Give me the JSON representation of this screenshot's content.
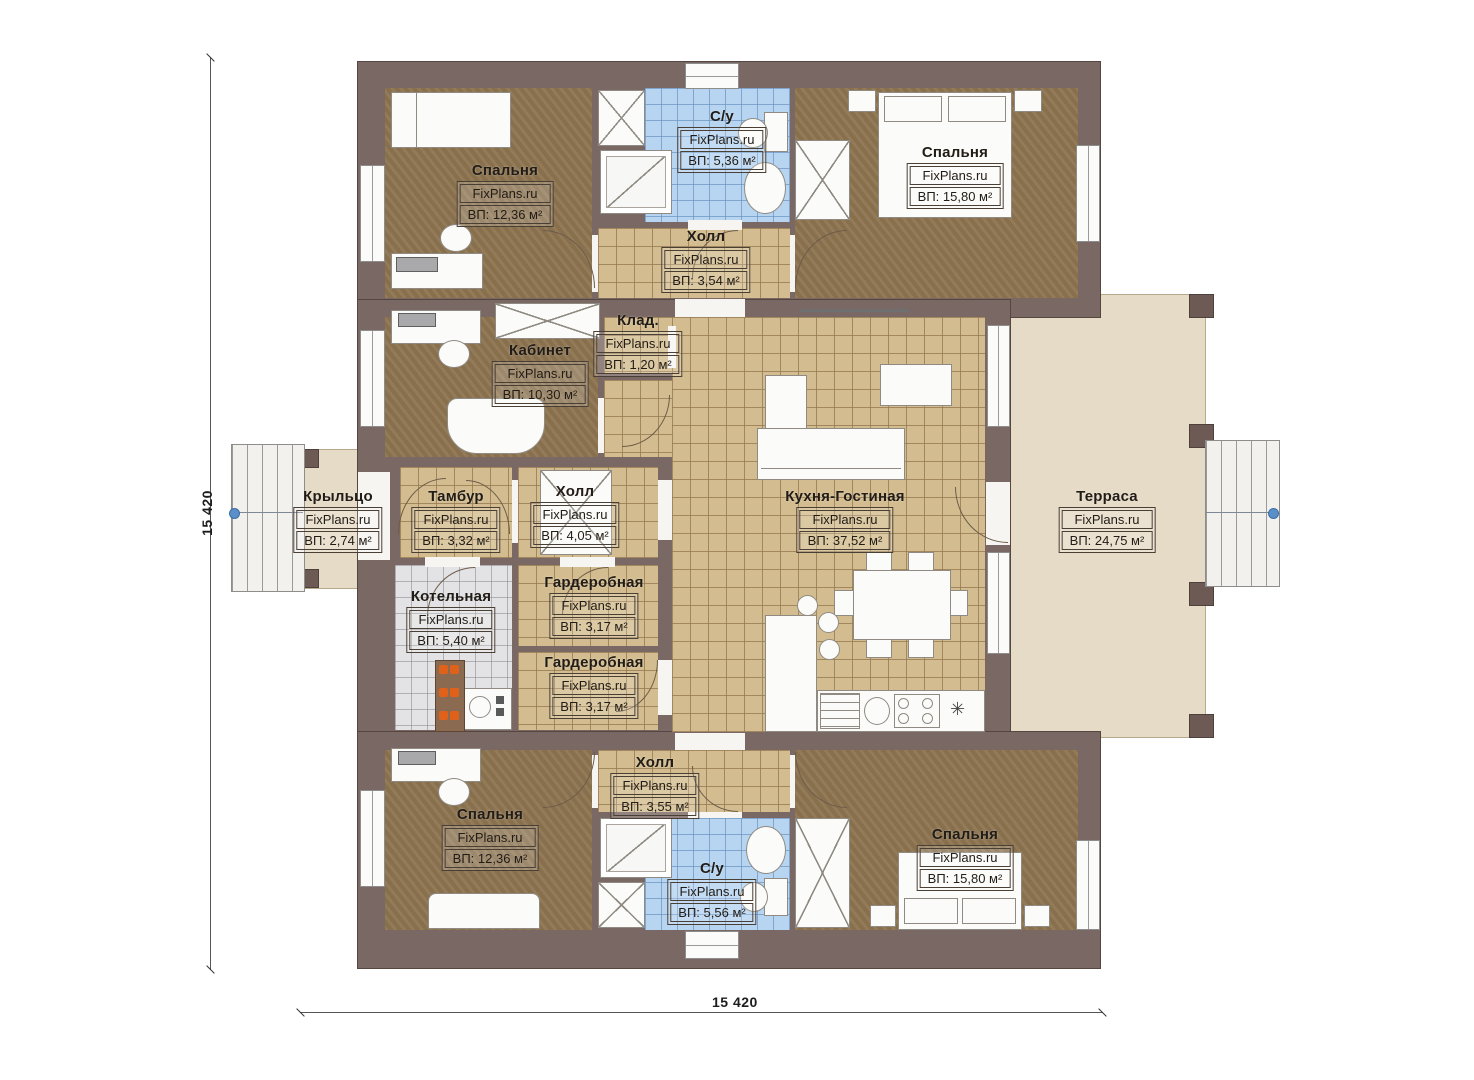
{
  "plan": {
    "watermark": "FixPlans.ru",
    "dimensions": {
      "left": "15 420",
      "bottom": "15 420"
    },
    "symbols": {
      "vent_symbol": "✳"
    },
    "colors": {
      "wall": "#7a6864",
      "floor_wood": "#8d7450",
      "floor_tile_tan": "#d3bd90",
      "floor_tile_blue": "#b7d5f1",
      "floor_tile_gray": "#e3e3e5",
      "terrace_deck": "#e6dbc6",
      "axis_marker_blue": "#5b8fc9",
      "boiler_accent_orange": "#e0621a"
    }
  },
  "rooms": [
    {
      "id": "bedroom-top-left",
      "name": "Спальня",
      "watermark": "FixPlans.ru",
      "area": "ВП: 12,36 м²"
    },
    {
      "id": "bathroom-top",
      "name": "С/у",
      "watermark": "FixPlans.ru",
      "area": "ВП: 5,36 м²"
    },
    {
      "id": "bedroom-top-right",
      "name": "Спальня",
      "watermark": "FixPlans.ru",
      "area": "ВП: 15,80 м²"
    },
    {
      "id": "hall-top",
      "name": "Холл",
      "watermark": "FixPlans.ru",
      "area": "ВП: 3,54 м²"
    },
    {
      "id": "storage",
      "name": "Клад.",
      "watermark": "FixPlans.ru",
      "area": "ВП: 1,20 м²"
    },
    {
      "id": "office",
      "name": "Кабинет",
      "watermark": "FixPlans.ru",
      "area": "ВП: 10,30 м²"
    },
    {
      "id": "porch",
      "name": "Крыльцо",
      "watermark": "FixPlans.ru",
      "area": "ВП: 2,74 м²"
    },
    {
      "id": "vestibule",
      "name": "Тамбур",
      "watermark": "FixPlans.ru",
      "area": "ВП: 3,32 м²"
    },
    {
      "id": "hall-middle",
      "name": "Холл",
      "watermark": "FixPlans.ru",
      "area": "ВП: 4,05 м²"
    },
    {
      "id": "kitchen-living",
      "name": "Кухня-Гостиная",
      "watermark": "FixPlans.ru",
      "area": "ВП: 37,52 м²"
    },
    {
      "id": "terrace",
      "name": "Терраса",
      "watermark": "FixPlans.ru",
      "area": "ВП: 24,75 м²"
    },
    {
      "id": "boiler-room",
      "name": "Котельная",
      "watermark": "FixPlans.ru",
      "area": "ВП: 5,40 м²"
    },
    {
      "id": "wardrobe-upper",
      "name": "Гардеробная",
      "watermark": "FixPlans.ru",
      "area": "ВП: 3,17 м²"
    },
    {
      "id": "wardrobe-lower",
      "name": "Гардеробная",
      "watermark": "FixPlans.ru",
      "area": "ВП: 3,17 м²"
    },
    {
      "id": "hall-bottom",
      "name": "Холл",
      "watermark": "FixPlans.ru",
      "area": "ВП: 3,55 м²"
    },
    {
      "id": "bedroom-bottom-left",
      "name": "Спальня",
      "watermark": "FixPlans.ru",
      "area": "ВП: 12,36 м²"
    },
    {
      "id": "bathroom-bottom",
      "name": "С/у",
      "watermark": "FixPlans.ru",
      "area": "ВП: 5,56 м²"
    },
    {
      "id": "bedroom-bottom-right",
      "name": "Спальня",
      "watermark": "FixPlans.ru",
      "area": "ВП: 15,80 м²"
    }
  ]
}
